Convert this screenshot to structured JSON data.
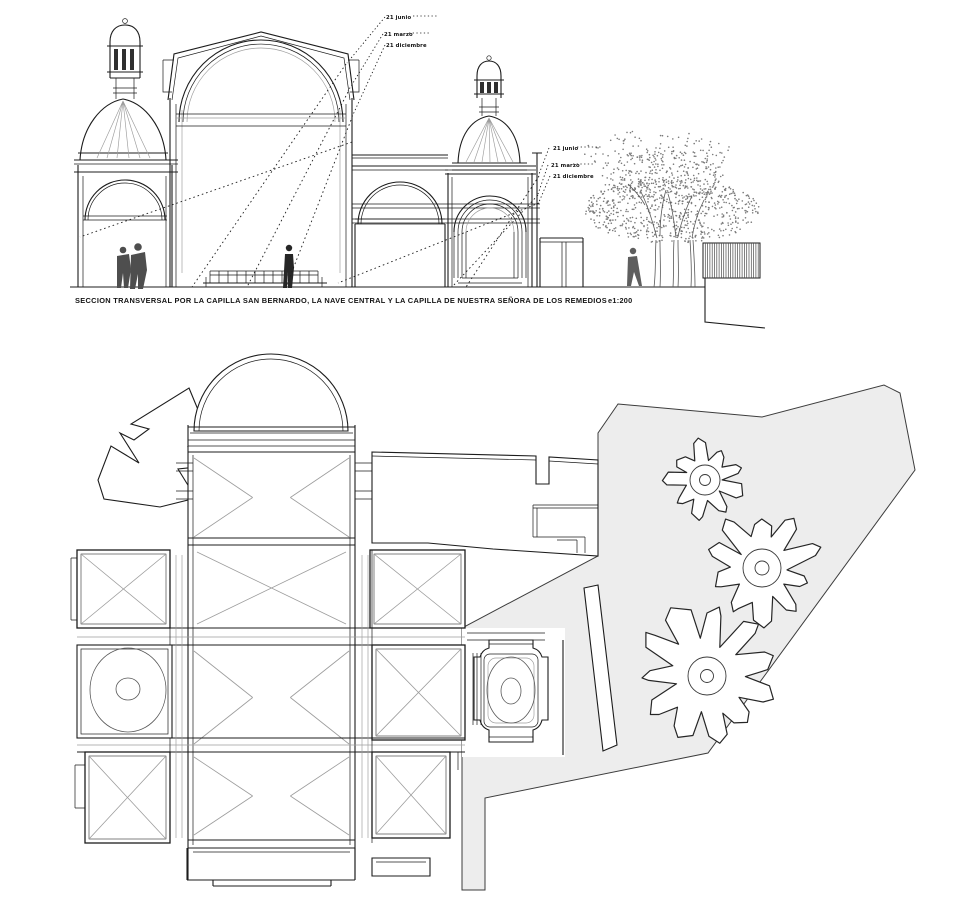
{
  "page": {
    "background": "#ffffff"
  },
  "colors": {
    "line": "#1c1c1c",
    "light_line": "#9c9c9c",
    "mid_line": "#585858",
    "courtyard_fill": "#ededed",
    "courtyard_stroke": "#3c3c3c",
    "canopy_dot": "#7b7b7b",
    "figure_fill": "#4e4e4e",
    "nave_figure_fill": "#262626",
    "walker_fill": "#5e5e5e"
  },
  "section": {
    "caption": "SECCION TRANSVERSAL POR LA CAPILLA SAN BERNARDO, LA NAVE CENTRAL Y LA CAPILLA DE NUESTRA SEÑORA DE LOS REMEDIOS",
    "scale_label": "e1:200",
    "sun_annotations": {
      "upper": [
        "21 junio",
        "21 marzo",
        "21 diciembre"
      ],
      "lower": [
        "21 junio",
        "21 marzo",
        "21 diciembre"
      ]
    },
    "tree_canopy": {
      "seed": 42,
      "dot_radius": 0.8,
      "clouds": [
        {
          "cx": 672,
          "cy": 210,
          "rx": 88,
          "ry": 33,
          "n": 640
        },
        {
          "cx": 662,
          "cy": 176,
          "rx": 62,
          "ry": 26,
          "n": 270
        },
        {
          "cx": 658,
          "cy": 152,
          "rx": 74,
          "ry": 22,
          "n": 115
        }
      ]
    },
    "fence": {
      "x": 703,
      "y": 243,
      "width": 57,
      "height": 35,
      "spacing": 2.3
    }
  },
  "plan": {
    "courtyard_trees": [
      {
        "cx": 705,
        "cy": 480,
        "r": 40,
        "lobes": 9,
        "seed": 3,
        "rings": [
          15,
          5.5
        ]
      },
      {
        "cx": 762,
        "cy": 568,
        "r": 58,
        "lobes": 10,
        "seed": 7,
        "rings": [
          19,
          7
        ]
      },
      {
        "cx": 707,
        "cy": 676,
        "r": 73,
        "lobes": 11,
        "seed": 11,
        "rings": [
          19,
          6.5
        ]
      }
    ],
    "vaulted_rooms": [
      {
        "x": 193,
        "y": 455,
        "w": 157,
        "h": 85,
        "type": "tri",
        "box": false
      },
      {
        "x": 193,
        "y": 548,
        "w": 157,
        "h": 80,
        "type": "cross",
        "box": false
      },
      {
        "x": 193,
        "y": 648,
        "w": 157,
        "h": 99,
        "type": "tri",
        "box": false
      },
      {
        "x": 193,
        "y": 754,
        "w": 157,
        "h": 84,
        "type": "tri",
        "box": false
      },
      {
        "x": 77,
        "y": 550,
        "w": 93,
        "h": 78,
        "type": "cross",
        "box": true
      },
      {
        "x": 85,
        "y": 752,
        "w": 85,
        "h": 91,
        "type": "cross",
        "box": true
      },
      {
        "x": 370,
        "y": 550,
        "w": 95,
        "h": 78,
        "type": "cross",
        "box": true
      },
      {
        "x": 372,
        "y": 645,
        "w": 93,
        "h": 95,
        "type": "cross",
        "box": true
      },
      {
        "x": 372,
        "y": 752,
        "w": 78,
        "h": 86,
        "type": "cross",
        "box": true
      }
    ]
  }
}
